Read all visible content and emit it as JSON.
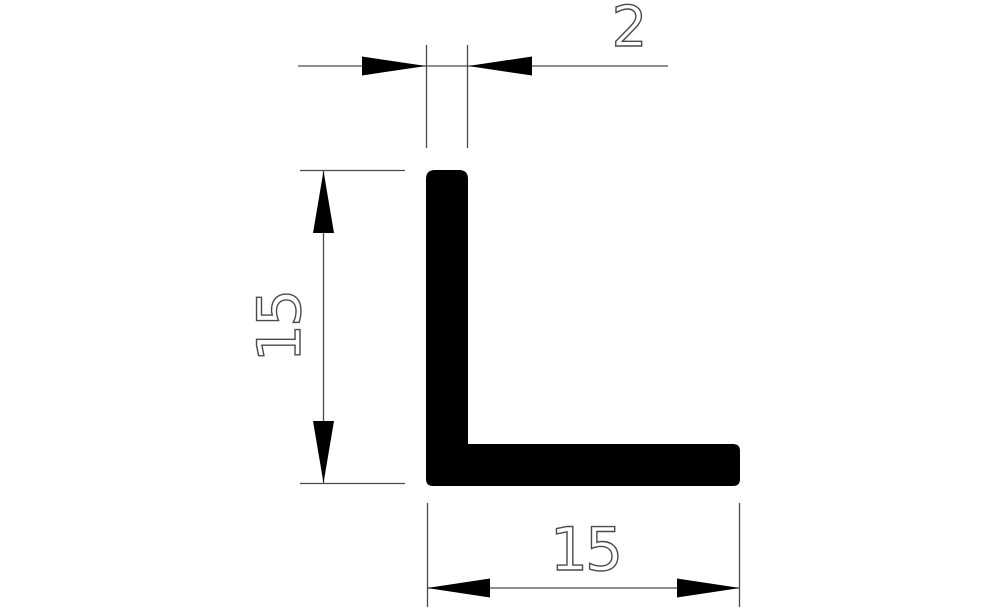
{
  "figure": {
    "type": "technical-drawing",
    "subject": "L-angle profile cross-section",
    "colors": {
      "background": "#ffffff",
      "profile_fill": "#000000",
      "dimension_line": "#4a4a4a",
      "dimension_text": "#4a4a4a"
    },
    "dimensions": {
      "thickness": {
        "label": "2",
        "position": "top"
      },
      "height": {
        "label": "15",
        "position": "left"
      },
      "width": {
        "label": "15",
        "position": "bottom"
      }
    }
  }
}
